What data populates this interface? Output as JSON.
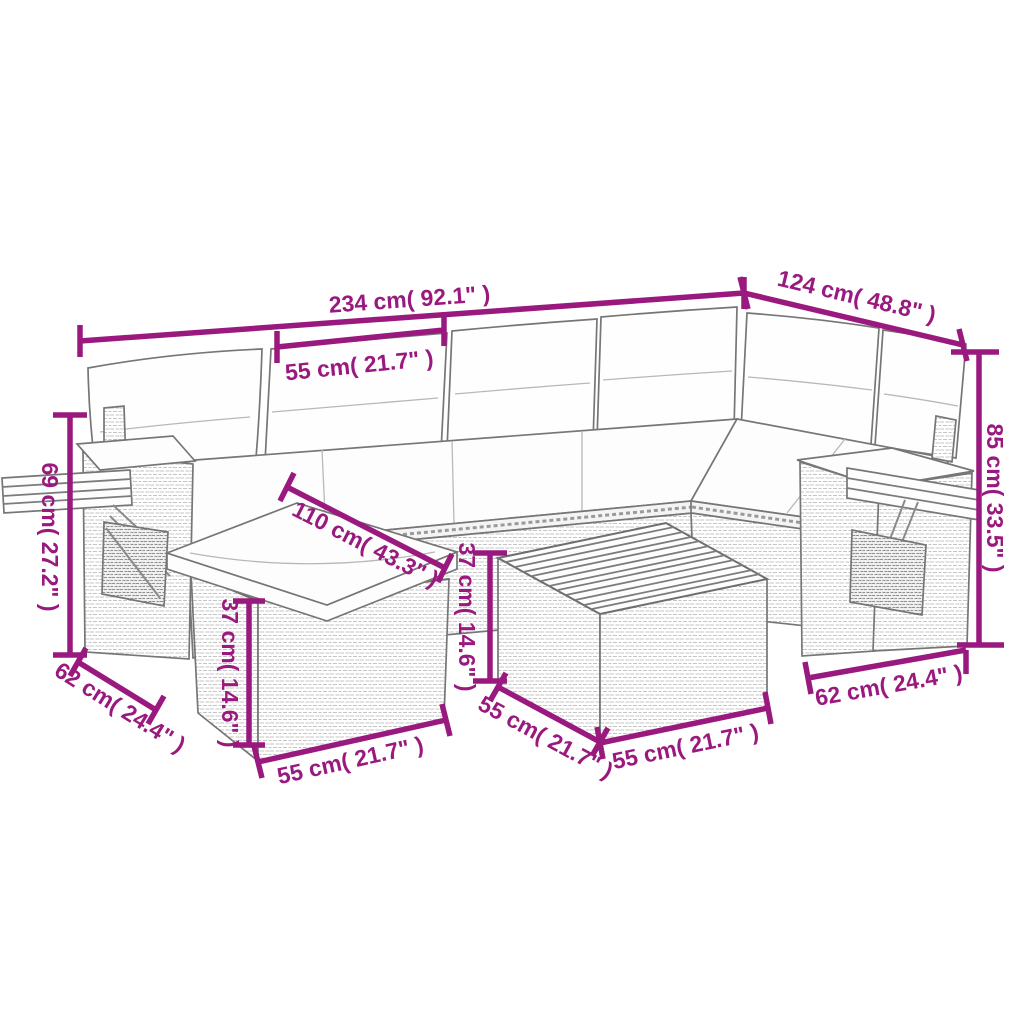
{
  "diagram": {
    "title": "Garden lounge set dimension diagram",
    "accent_color": "#9A197E",
    "background_color": "#ffffff",
    "dimensions": [
      {
        "name": "sofa-total-length",
        "label": "234 cm( 92.1\" )"
      },
      {
        "name": "back-cushion-width",
        "label": "55 cm( 21.7\" )"
      },
      {
        "name": "corner-section-length",
        "label": "124 cm( 48.8\" )"
      },
      {
        "name": "total-height",
        "label": "85 cm( 33.5\" )"
      },
      {
        "name": "armrest-height",
        "label": "69 cm( 27.2\" )"
      },
      {
        "name": "seat-plus-footstool-depth",
        "label": "110 cm( 43.3\" )"
      },
      {
        "name": "footstool-height",
        "label": "37 cm( 14.6\" )"
      },
      {
        "name": "footstool-front-width",
        "label": "55 cm( 21.7\" )"
      },
      {
        "name": "left-side-depth",
        "label": "62 cm( 24.4\" )"
      },
      {
        "name": "table-height",
        "label": "37 cm( 14.6\" )"
      },
      {
        "name": "table-side-depth",
        "label": "55 cm( 21.7\" )"
      },
      {
        "name": "table-front-width",
        "label": "55 cm( 21.7\" )"
      },
      {
        "name": "right-side-depth",
        "label": "62 cm( 24.4\" )"
      }
    ]
  }
}
